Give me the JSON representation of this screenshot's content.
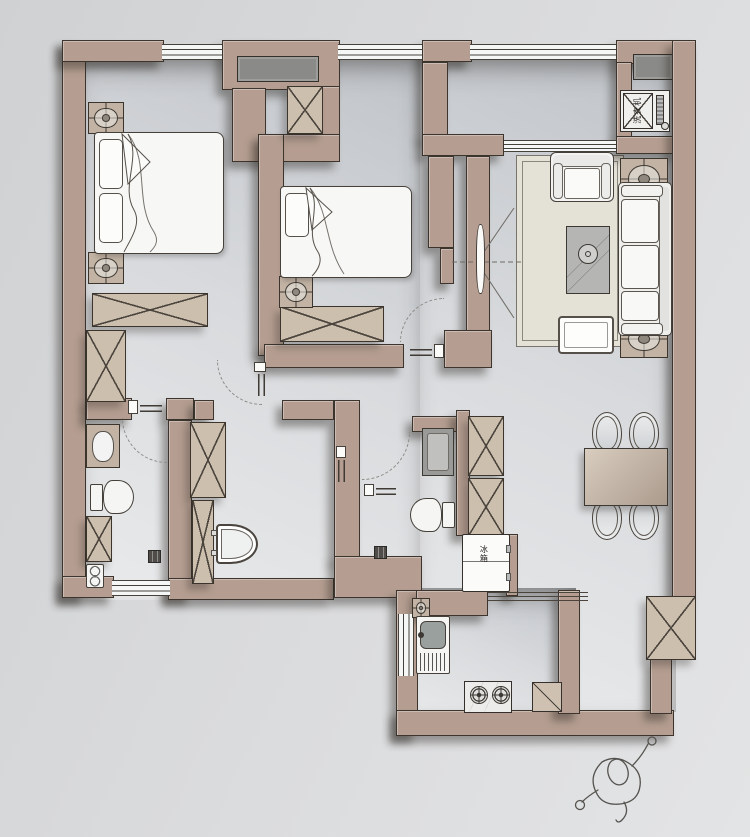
{
  "document": {
    "kind": "residential floor plan (top-down interior layout rendering)"
  },
  "labels": {
    "washing_machine": "洗衣机",
    "fridge": "冰箱"
  },
  "palette": {
    "wall": "#b59e91",
    "wall_cabinet_fill": "#cdbfae",
    "outline": "#3b352e",
    "floor_dark": "#c0c4c9",
    "floor_light": "#e9eaeb",
    "background": "#d9dadc",
    "rug": "#e4e1d7",
    "fixture_white": "#f5f5f4",
    "niche_dark": "#8a8a88"
  },
  "rooms": [
    {
      "name": "master-bedroom",
      "fixtures": [
        "double-bed",
        "nightstand-lamp",
        "nightstand-lamp",
        "wardrobe",
        "wardrobe",
        "window"
      ]
    },
    {
      "name": "bedroom-2",
      "fixtures": [
        "single-bed",
        "nightstand-lamp",
        "wardrobe",
        "duct-shaft",
        "window"
      ]
    },
    {
      "name": "living-room",
      "fixtures": [
        "armchair",
        "sofa",
        "coffee-table",
        "plant",
        "tv",
        "side-table-lamp",
        "side-table-lamp",
        "rug"
      ]
    },
    {
      "name": "laundry-niche",
      "fixtures": [
        "washing-machine",
        "niche-window"
      ]
    },
    {
      "name": "dining-area",
      "fixtures": [
        "dining-table",
        "dining-chair",
        "dining-chair",
        "dining-chair",
        "dining-chair",
        "tall-cabinet"
      ]
    },
    {
      "name": "bathroom-1",
      "fixtures": [
        "washbasin",
        "toilet",
        "storage-cabinet",
        "double-bowl-unit",
        "shower-drain",
        "window"
      ]
    },
    {
      "name": "shower-room",
      "fixtures": [
        "tall-cabinet",
        "tall-cabinet",
        "toilet-seat"
      ]
    },
    {
      "name": "bathroom-2",
      "fixtures": [
        "vanity-sink",
        "toilet",
        "shower-drain"
      ]
    },
    {
      "name": "hallway",
      "fixtures": [
        "tall-cabinet",
        "tall-cabinet",
        "fridge",
        "entry-door",
        "door-swing-arcs"
      ]
    },
    {
      "name": "kitchen",
      "fixtures": [
        "kitchen-sink",
        "gas-stove",
        "corner-counter",
        "sliding-door",
        "column-marker",
        "window"
      ]
    }
  ],
  "extras": [
    "person-sketch-top-view"
  ]
}
